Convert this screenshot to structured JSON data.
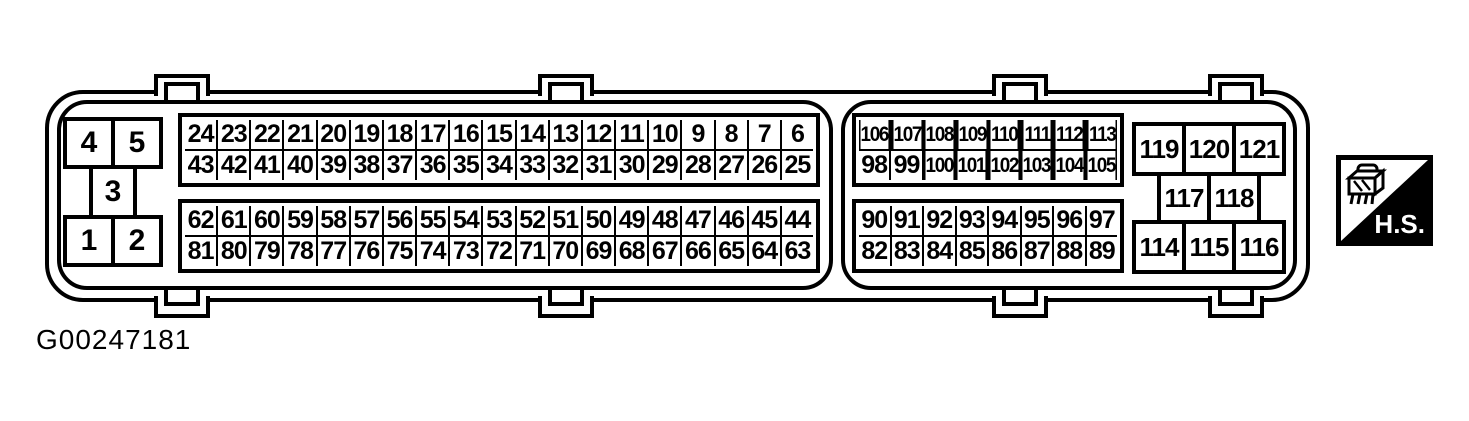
{
  "caption": "G00247181",
  "hs_badge": {
    "label": "H.S.",
    "icon": "connector-icon"
  },
  "colors": {
    "line": "#000000",
    "background": "#ffffff",
    "badge_bg": "#000000",
    "badge_text": "#ffffff"
  },
  "left_block": {
    "top_row": [
      "4",
      "5"
    ],
    "middle_row": [
      "3"
    ],
    "bottom_row": [
      "1",
      "2"
    ]
  },
  "pins": {
    "grid_top_left": {
      "row1": [
        "24",
        "23",
        "22",
        "21",
        "20",
        "19",
        "18",
        "17",
        "16",
        "15",
        "14",
        "13",
        "12",
        "11",
        "10",
        "9",
        "8",
        "7",
        "6"
      ],
      "row2": [
        "43",
        "42",
        "41",
        "40",
        "39",
        "38",
        "37",
        "36",
        "35",
        "34",
        "33",
        "32",
        "31",
        "30",
        "29",
        "28",
        "27",
        "26",
        "25"
      ]
    },
    "grid_bottom_left": {
      "row1": [
        "62",
        "61",
        "60",
        "59",
        "58",
        "57",
        "56",
        "55",
        "54",
        "53",
        "52",
        "51",
        "50",
        "49",
        "48",
        "47",
        "46",
        "45",
        "44"
      ],
      "row2": [
        "81",
        "80",
        "79",
        "78",
        "77",
        "76",
        "75",
        "74",
        "73",
        "72",
        "71",
        "70",
        "69",
        "68",
        "67",
        "66",
        "65",
        "64",
        "63"
      ]
    },
    "grid_top_right": {
      "row1": [
        "106",
        "107",
        "108",
        "109",
        "110",
        "111",
        "112",
        "113"
      ],
      "row2": [
        "98",
        "99",
        "100",
        "101",
        "102",
        "103",
        "104",
        "105"
      ]
    },
    "grid_bottom_right": {
      "row1": [
        "90",
        "91",
        "92",
        "93",
        "94",
        "95",
        "96",
        "97"
      ],
      "row2": [
        "82",
        "83",
        "84",
        "85",
        "86",
        "87",
        "88",
        "89"
      ]
    }
  },
  "right_block": {
    "top_row": [
      "119",
      "120",
      "121"
    ],
    "middle_row": [
      "117",
      "118"
    ],
    "bottom_row": [
      "114",
      "115",
      "116"
    ]
  }
}
